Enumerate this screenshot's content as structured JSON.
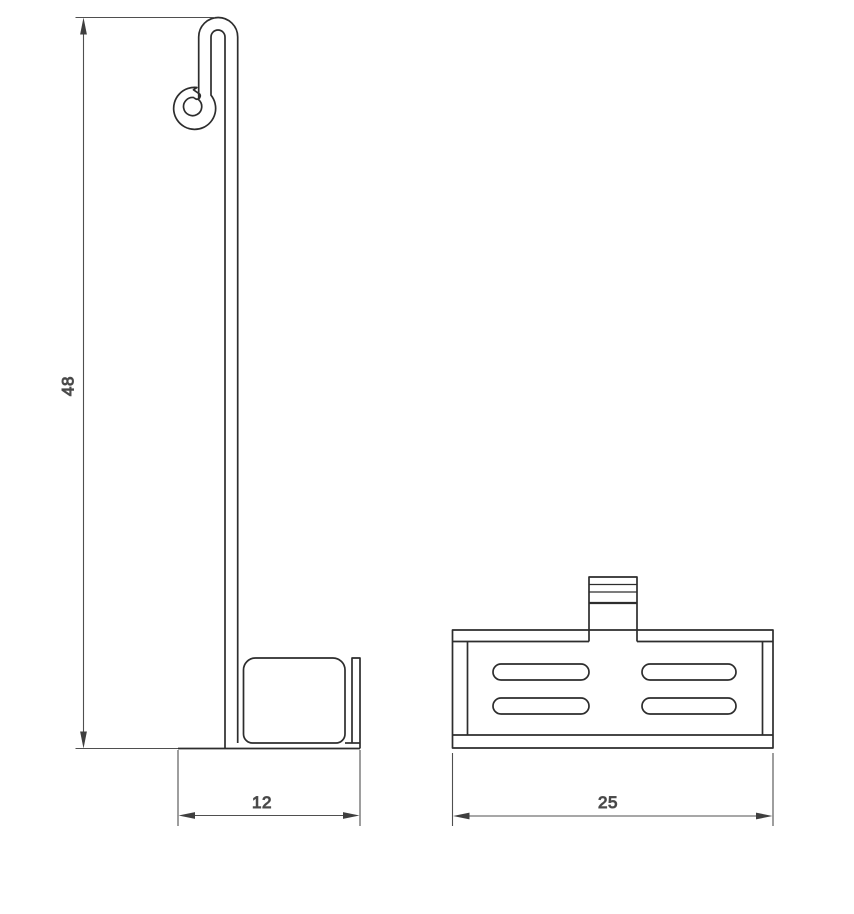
{
  "diagram": {
    "background_color": "#ffffff",
    "part_line_color": "#2d2d2d",
    "dimension_line_color": "#4f4f4f",
    "dimension_text_color": "#3a3a3a",
    "views": [
      "side-view",
      "front-view"
    ],
    "dimensions": [
      {
        "id": "height",
        "label": "48"
      },
      {
        "id": "depth",
        "label": "12"
      },
      {
        "id": "width",
        "label": "25"
      }
    ]
  }
}
